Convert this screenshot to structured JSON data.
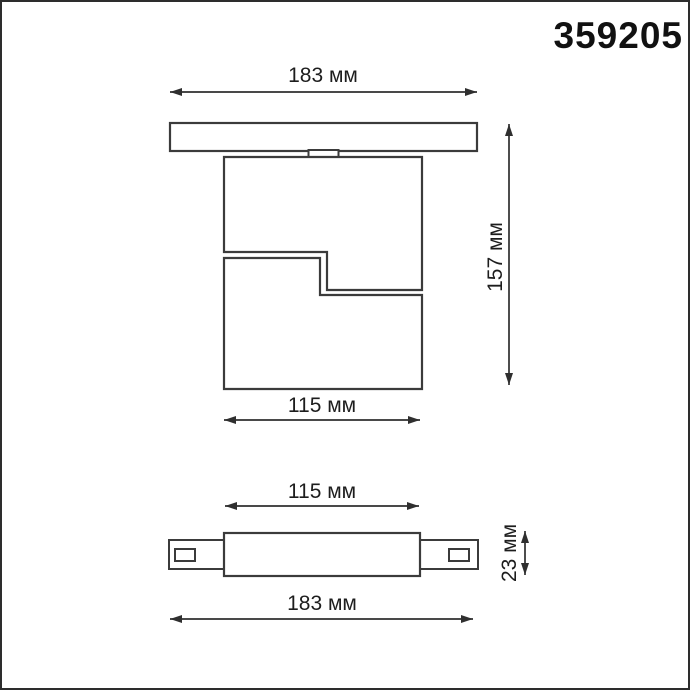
{
  "title": "359205",
  "colors": {
    "line": "#3b3b3b",
    "dimension_line": "#2f2f2f",
    "text": "#1d1d1d",
    "page_border": "#2d2d2d",
    "background": "#ffffff"
  },
  "front_view": {
    "overall_width": {
      "value": 183,
      "unit": "мм",
      "label": "183 мм"
    },
    "overall_height": {
      "value": 157,
      "unit": "мм",
      "label": "157 мм"
    },
    "body_width": {
      "value": 115,
      "unit": "мм",
      "label": "115 мм"
    }
  },
  "bottom_view": {
    "body_width": {
      "value": 115,
      "unit": "мм",
      "label": "115 мм"
    },
    "profile_height": {
      "value": 23,
      "unit": "мм",
      "label": "23 мм"
    },
    "overall_width": {
      "value": 183,
      "unit": "мм",
      "label": "183 мм"
    }
  }
}
